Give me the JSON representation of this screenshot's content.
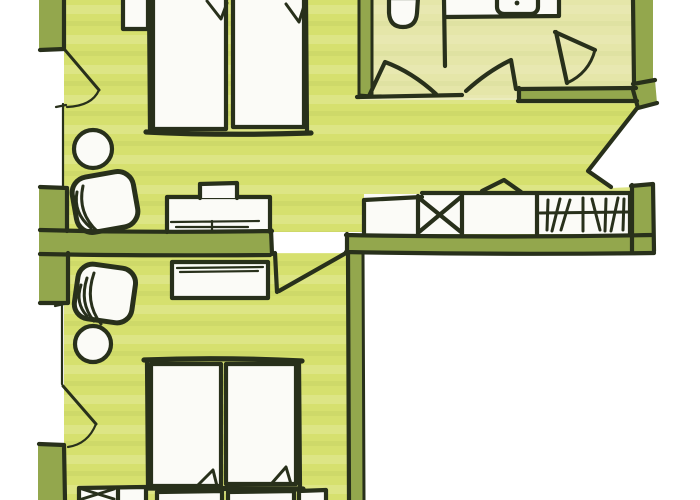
{
  "image_kind": "hand-drawn floor plan sketch, marker style, no visible text",
  "colors": {
    "paper": "#ffffff",
    "ink": "#28301b",
    "wall": "#93a74d",
    "floor_main": "#d6e06e",
    "floor_pale": "#e5e6a9",
    "furniture": "#fbfbf7",
    "streak_light": "#ffffff",
    "streak_dark": "#8aa23c"
  },
  "rooms": [
    {
      "name": "bedroom-top",
      "floor": "bright yellow-green"
    },
    {
      "name": "bedroom-bottom",
      "floor": "bright yellow-green"
    },
    {
      "name": "bathroom-toilet-compartment",
      "floor": "pale yellow"
    },
    {
      "name": "bathroom-sink-entry",
      "floor": "pale yellow"
    },
    {
      "name": "corridor",
      "floor": "bright yellow-green"
    }
  ],
  "furniture": [
    "twin-beds-top-with-folded-blankets",
    "nightstand-top-left",
    "round-side-table-1",
    "armchair-1",
    "desk",
    "desk-chair",
    "wardrobe-row-with-x-symbol-and-hanger-marks",
    "toilet",
    "sink-counter",
    "sink-basin",
    "dresser",
    "armchair-2",
    "round-side-table-2",
    "twin-beds-bottom-with-folded-blankets",
    "nightstand-bottom-left-x",
    "nightstand-bottom-right",
    "pillows-bottom"
  ],
  "doors": [
    "balcony-door-bedroom-top",
    "balcony-door-bedroom-bottom",
    "door-toilet-compartment",
    "door-bathroom-sink",
    "apartment-entry-door",
    "door-bedroom-bottom"
  ]
}
